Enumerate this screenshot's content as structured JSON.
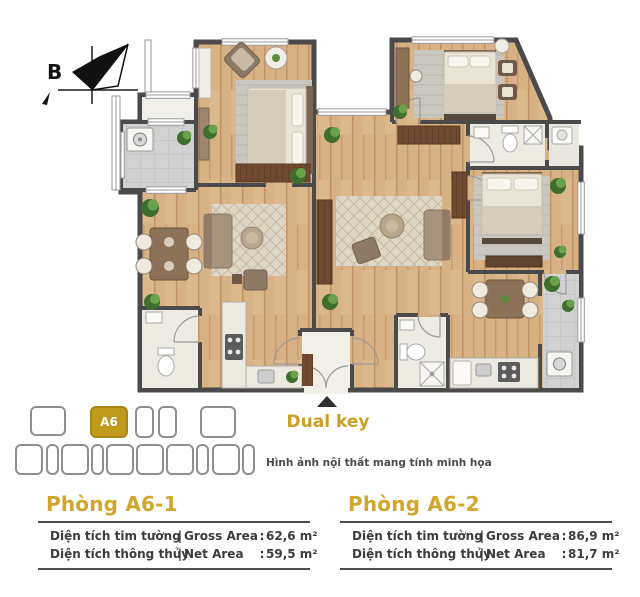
{
  "compass": {
    "label": "B"
  },
  "floor_plan": {
    "entrance_label": "Dual key",
    "disclaimer": "Hình ảnh nội thất mang tính minh họa"
  },
  "key_plan": {
    "highlighted_unit": "A6"
  },
  "labels": {
    "separator": "|",
    "colon": ":"
  },
  "units": [
    {
      "title": "Phòng A6-1",
      "rows": [
        {
          "viet": "Diện tích tim tường",
          "eng": "Gross Area",
          "value": "62,6 m²"
        },
        {
          "viet": "Diện tích thông thủy",
          "eng": "Net Area",
          "value": "59,5 m²"
        }
      ]
    },
    {
      "title": "Phòng A6-2",
      "rows": [
        {
          "viet": "Diện tích tim tường",
          "eng": "Gross Area",
          "value": "86,9 m²"
        },
        {
          "viet": "Diện tích thông thủy",
          "eng": "Net Area",
          "value": "81,7 m²"
        }
      ]
    }
  ],
  "colors": {
    "accent_gold": "#CB9F24",
    "wall": "#4a4a4a",
    "text_dark": "#3c3c3c"
  }
}
